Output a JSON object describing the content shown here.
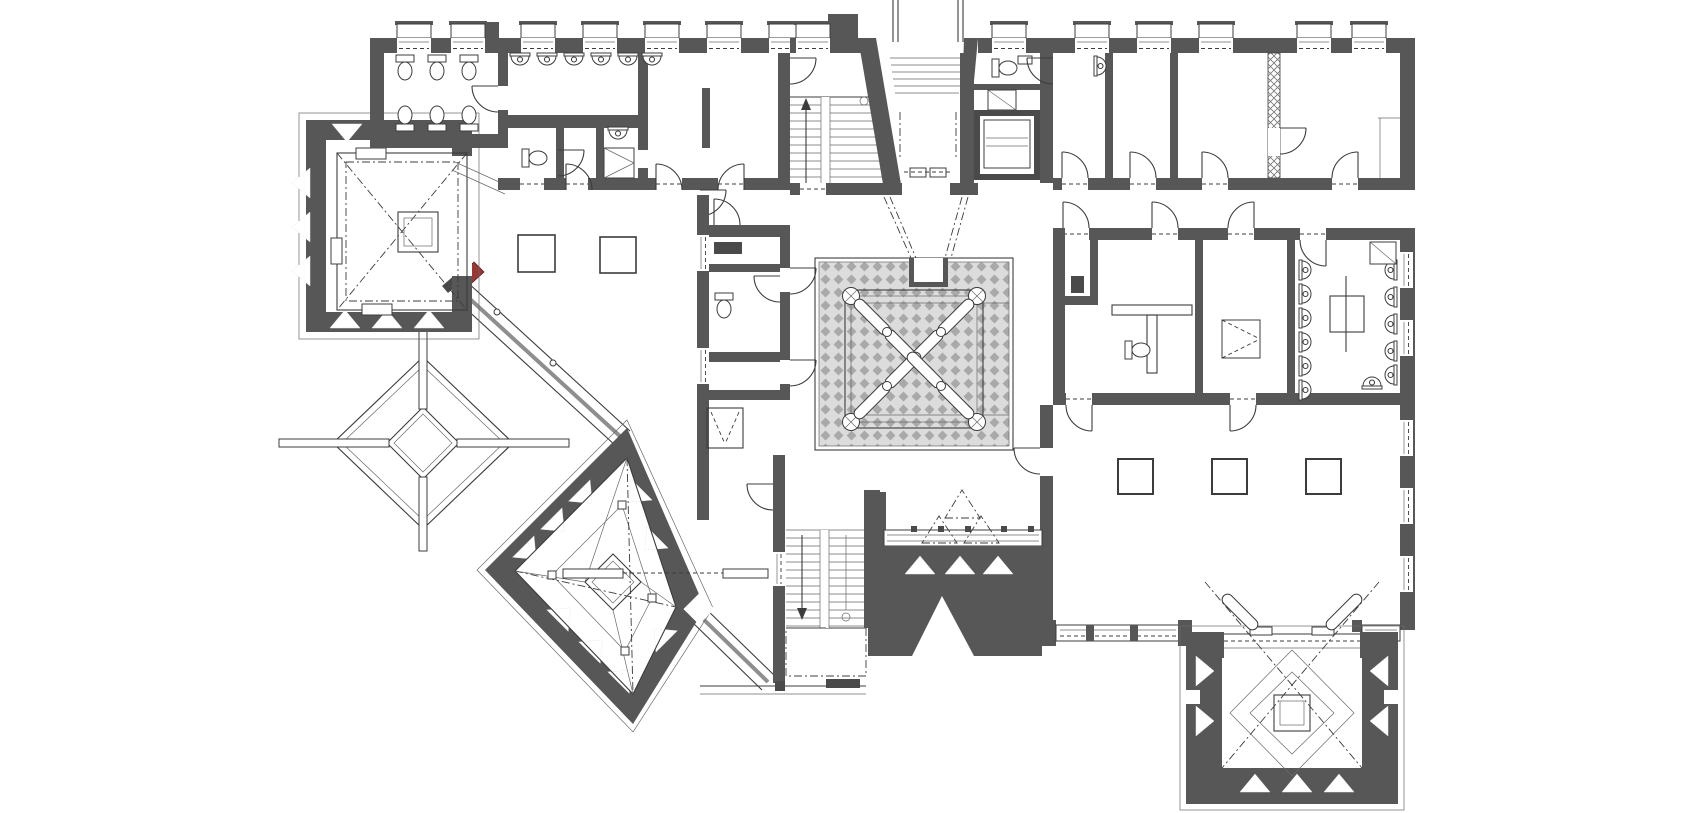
{
  "palette": {
    "background": "#ffffff",
    "wall": "#575757",
    "wall_dark": "#4a4a4a",
    "line": "#3c3c3c",
    "hatch_bg": "#dcdcdc",
    "hatch_fg": "#a9a9a9",
    "ridge": "#8e8e8e",
    "accent_red": "#993733"
  },
  "drawing": {
    "kind": "architectural-floor-plan",
    "regions": {
      "northwest_wing": "sanitary rooms with toilets, wash basins, shower and seminar room",
      "north_stair": "straight staircase with up arrow",
      "north_entrance": "vestibule with exterior steps and double door",
      "elevator": "elevator shaft with car",
      "northeast_wing": "room row with corridor doors and glass-block partition",
      "central_atrium": "hatched skylight court with four cross columns and diagonal braces",
      "east_strip": "service rooms with urinals, basins, shower and tables",
      "southeast_hall": "large hall with three square columns and window bands",
      "south_entrance": "dark entry block with white triangle steps and dashed pyramid skylights",
      "south_stair": "straight staircase with landing",
      "northwest_tower": "square skylight tower with white wall triangles and concentric frames",
      "southwest_tower": "rotated diamond skylight tower with wall triangles",
      "southeast_tower": "square skylight tower with wall triangles",
      "garden_ornament": "freestanding double-line diamond with cross arms",
      "glass_corridors": "two diagonal glazed corridors with gray ridge line"
    },
    "glyphs": [
      "toilet-icon",
      "wash-basin-icon",
      "urinal-icon",
      "shower-icon",
      "door-swing-icon",
      "stair-run-icon",
      "elevator-car-icon",
      "square-column-icon",
      "cross-column-icon",
      "roof-brace-icon",
      "wall-triangle-icon",
      "window-icon",
      "canopy-dash-icon"
    ]
  }
}
